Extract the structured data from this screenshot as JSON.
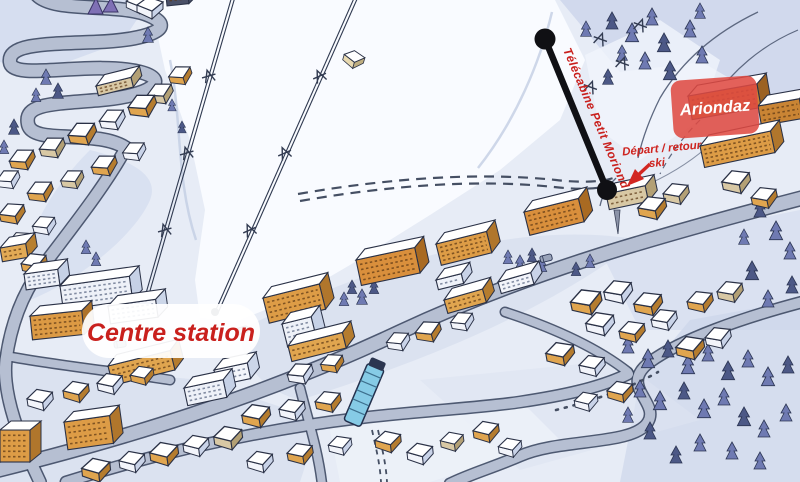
{
  "map": {
    "labels": {
      "centre_station": "Centre station",
      "ariondaz": "Ariondaz",
      "telecabine": "Télécabine Petit Moriond",
      "depart_retour": "Départ / retour",
      "ski": "ski"
    },
    "colors": {
      "label_red": "#c9201d",
      "ariondaz_box": "#df4a41",
      "ariondaz_text": "#ffffff",
      "snow_base": "#e9edf6",
      "snow_shadow": "#ccd6ec",
      "slope_white": "#fafcff",
      "road_fill": "#b6bfd2",
      "road_casing": "#46536e",
      "building_orange": "#e0a54f",
      "building_brown": "#c98434",
      "roof_white": "#ffffff",
      "tree_blue": "#6f7ab2",
      "gondola_black": "#101014",
      "escalator_blue": "#86cbe6"
    }
  }
}
